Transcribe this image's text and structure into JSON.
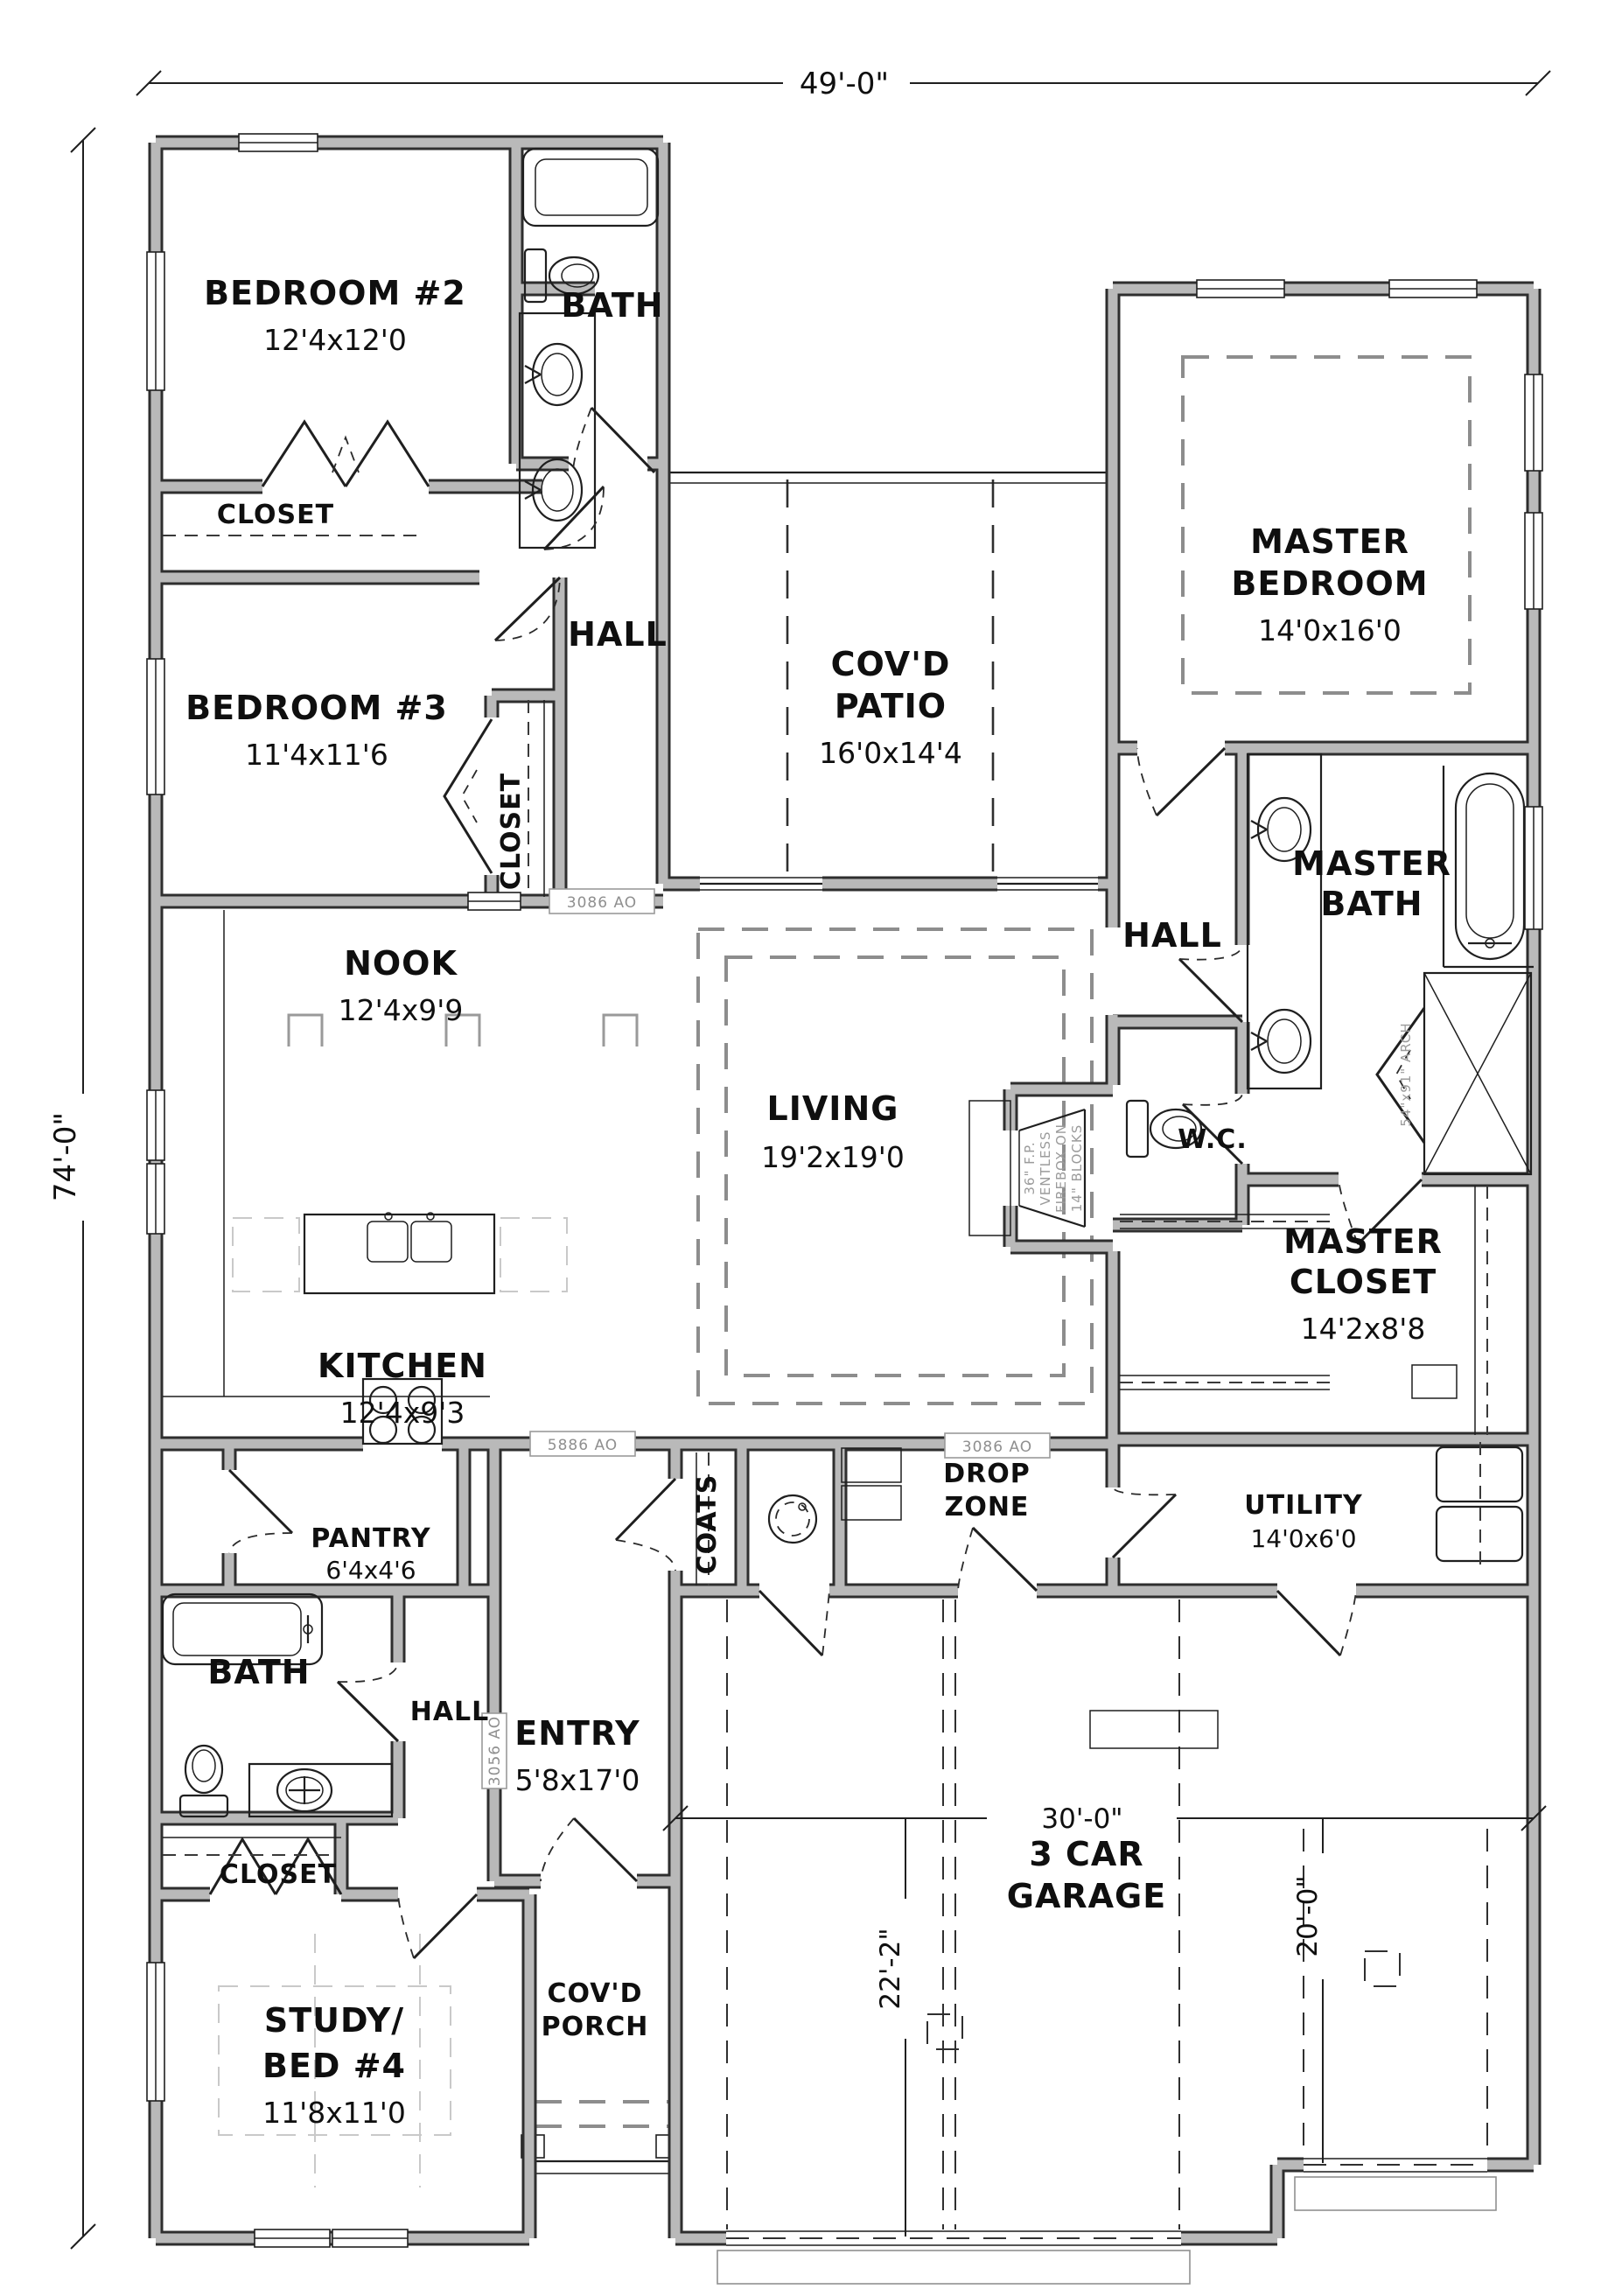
{
  "plan": {
    "overall": {
      "width": "49'-0\"",
      "height": "74'-0\""
    },
    "rooms": {
      "bedroom2": {
        "name": "BEDROOM #2",
        "size": "12'4x12'0"
      },
      "bath2": {
        "name": "BATH"
      },
      "closet2": {
        "name": "CLOSET"
      },
      "bedroom3": {
        "name": "BEDROOM #3",
        "size": "11'4x11'6"
      },
      "closet3": {
        "name": "CLOSET"
      },
      "hall_bed": {
        "name": "HALL"
      },
      "patio": {
        "name1": "COV'D",
        "name2": "PATIO",
        "size": "16'0x14'4"
      },
      "master_bedroom": {
        "name1": "MASTER",
        "name2": "BEDROOM",
        "size": "14'0x16'0"
      },
      "master_bath": {
        "name1": "MASTER",
        "name2": "BATH"
      },
      "hall_master": {
        "name": "HALL"
      },
      "wc": {
        "name": "W.C."
      },
      "master_closet": {
        "name1": "MASTER",
        "name2": "CLOSET",
        "size": "14'2x8'8"
      },
      "nook": {
        "name": "NOOK",
        "size": "12'4x9'9"
      },
      "living": {
        "name": "LIVING",
        "size": "19'2x19'0"
      },
      "kitchen": {
        "name": "KITCHEN",
        "size": "12'4x9'3"
      },
      "pantry": {
        "name": "PANTRY",
        "size": "6'4x4'6"
      },
      "coats": {
        "name": "COATS"
      },
      "drop_zone": {
        "name1": "DROP",
        "name2": "ZONE"
      },
      "utility": {
        "name": "UTILITY",
        "size": "14'0x6'0"
      },
      "bath3": {
        "name": "BATH"
      },
      "hall_entry": {
        "name": "HALL"
      },
      "entry": {
        "name": "ENTRY",
        "size": "5'8x17'0"
      },
      "closet4": {
        "name": "CLOSET"
      },
      "study": {
        "name1": "STUDY/",
        "name2": "BED #4",
        "size": "11'8x11'0"
      },
      "porch": {
        "name1": "COV'D",
        "name2": "PORCH"
      },
      "garage": {
        "name1": "3 CAR",
        "name2": "GARAGE"
      }
    },
    "garage_dims": {
      "width": "30'-0\"",
      "left_bay": "22'-2\"",
      "right_bay": "20'-0\""
    },
    "tags": {
      "hall_opening": "3086 AO",
      "kitchen_opening": "5886 AO",
      "dropzone_opening": "3086 AO",
      "entry_door": "3056 AO"
    },
    "annotations": {
      "shower_arch": "54\"x91\" ARCH",
      "fp1": "36\" F.P.",
      "fp2": "VENTLESS",
      "fp3": "FIREBOX ON",
      "fp4": "14\" BLOCKS"
    }
  }
}
